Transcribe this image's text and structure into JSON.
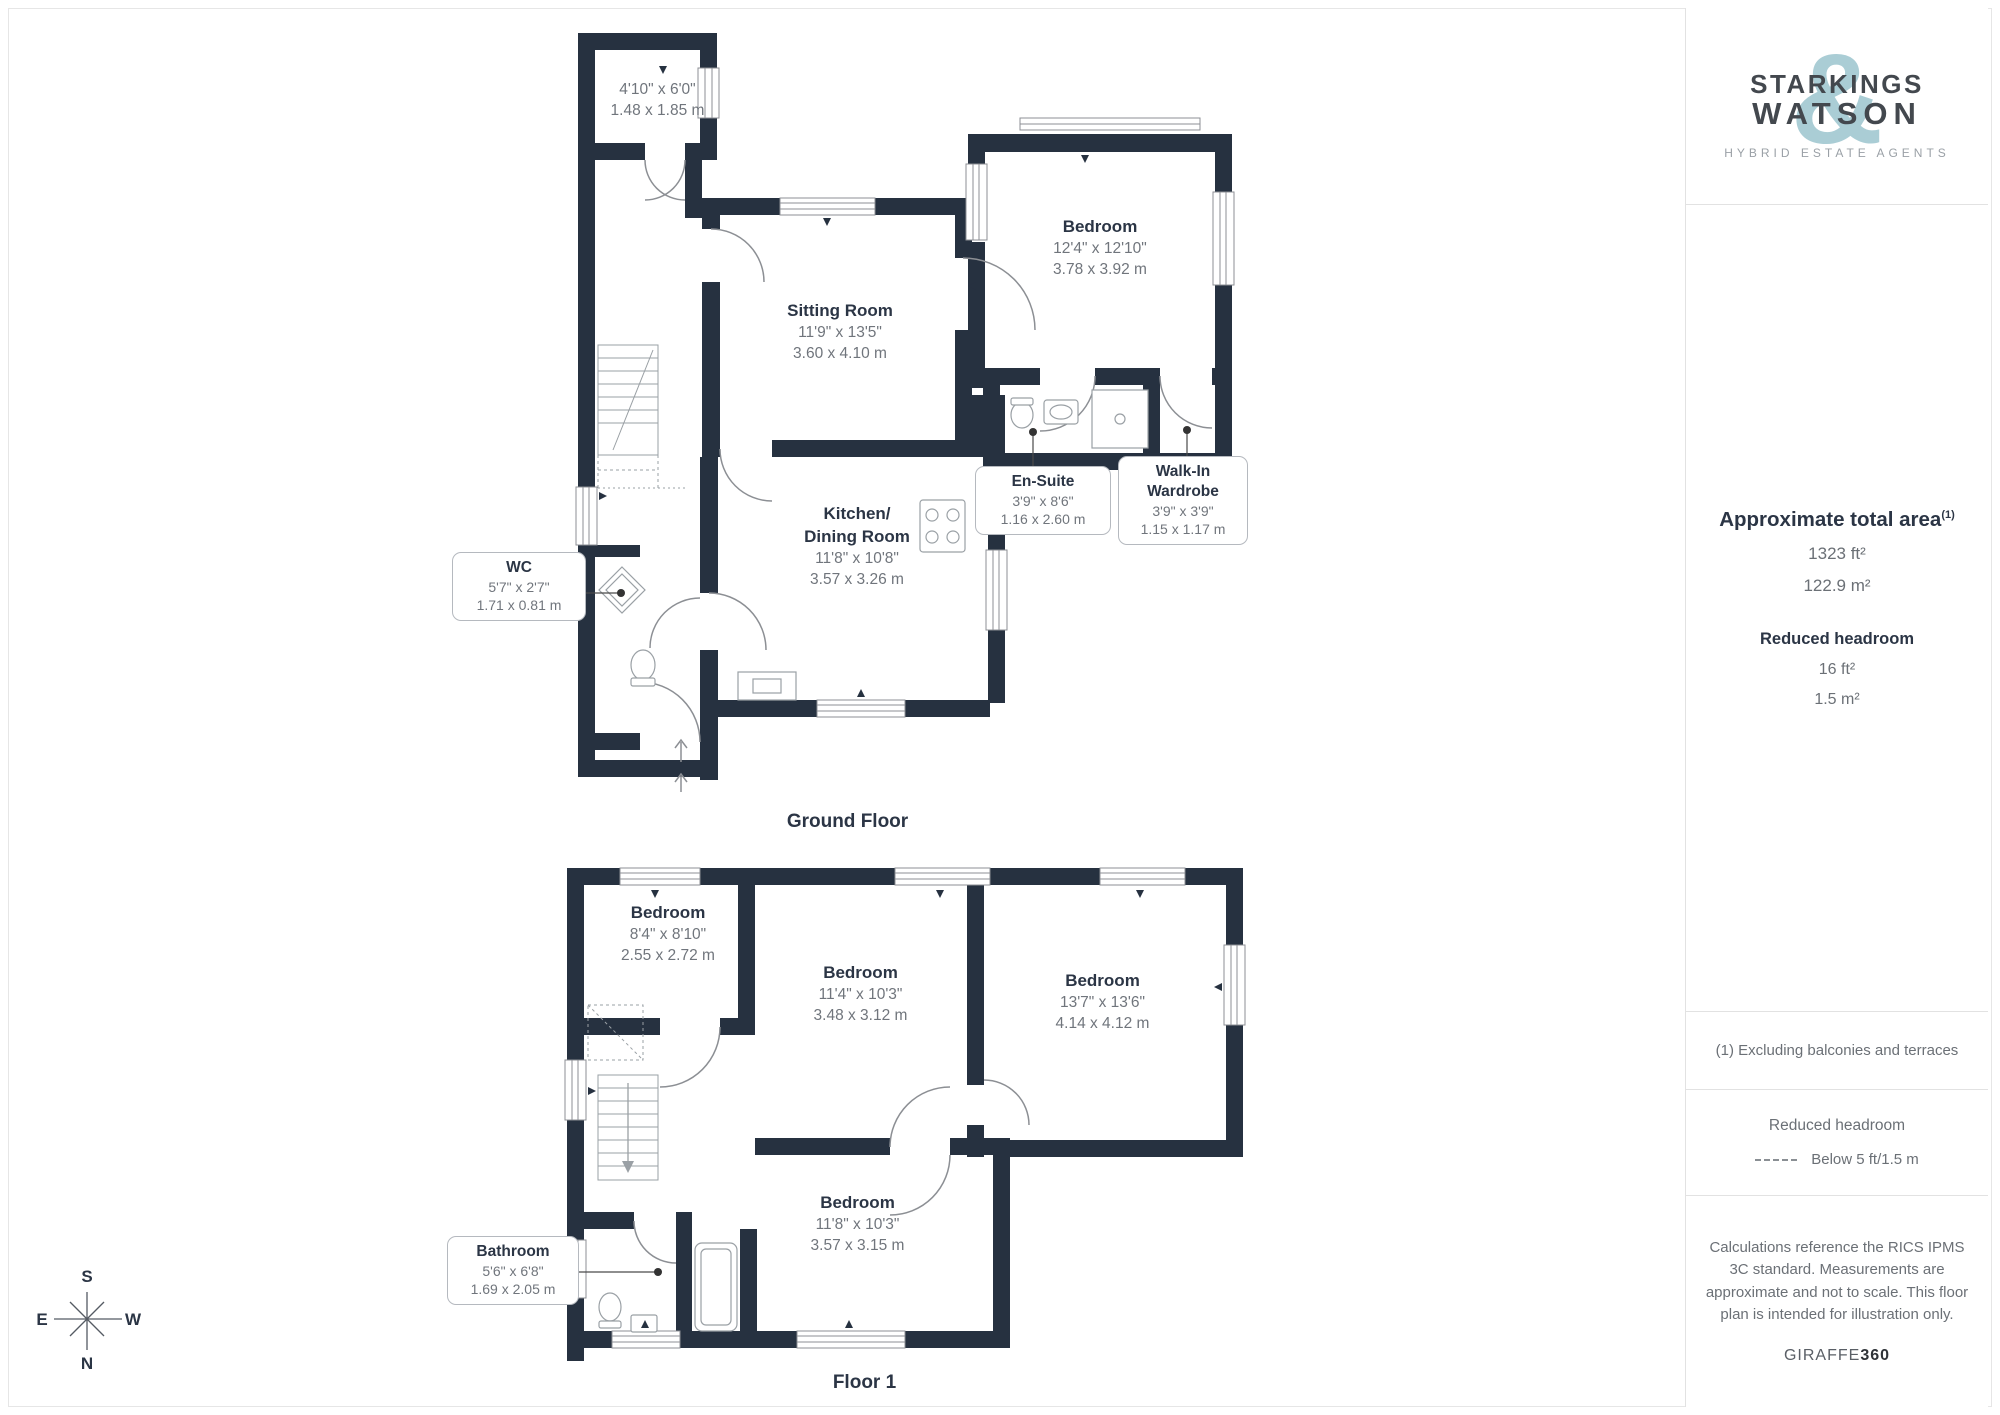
{
  "branding": {
    "logo_line1": "STARKINGS",
    "logo_line2": "WATSON",
    "logo_ampersand": "&",
    "tagline": "HYBRID ESTATE AGENTS"
  },
  "sidebar": {
    "area_title": "Approximate total area",
    "area_sup": "(1)",
    "area_ft": "1323 ft²",
    "area_m": "122.9 m²",
    "reduced_title": "Reduced headroom",
    "reduced_ft": "16 ft²",
    "reduced_m": "1.5 m²",
    "note1": "(1) Excluding balconies and terraces",
    "legend_title": "Reduced headroom",
    "legend_value": "Below 5 ft/1.5 m",
    "disclaimer": "Calculations reference the RICS IPMS 3C standard. Measurements are approximate and not to scale. This floor plan is intended for illustration only.",
    "brand_giraffe": "GIRAFFE",
    "brand_360": "360"
  },
  "ground_floor": {
    "title": "Ground Floor",
    "store": {
      "ft": "4'10\" x 6'0\"",
      "m": "1.48 x 1.85 m"
    },
    "sitting": {
      "name": "Sitting Room",
      "ft": "11'9\" x 13'5\"",
      "m": "3.60 x 4.10 m"
    },
    "bedroom": {
      "name": "Bedroom",
      "ft": "12'4\" x 12'10\"",
      "m": "3.78 x 3.92 m"
    },
    "ensuite": {
      "name": "En-Suite",
      "ft": "3'9\" x 8'6\"",
      "m": "1.16 x 2.60 m"
    },
    "wardrobe": {
      "name": "Walk-In\nWardrobe",
      "ft": "3'9\" x 3'9\"",
      "m": "1.15 x 1.17 m"
    },
    "kitchen": {
      "name": "Kitchen/\nDining Room",
      "ft": "11'8\" x 10'8\"",
      "m": "3.57 x 3.26 m"
    },
    "wc": {
      "name": "WC",
      "ft": "5'7\" x 2'7\"",
      "m": "1.71 x 0.81 m"
    }
  },
  "floor_1": {
    "title": "Floor 1",
    "bed_small": {
      "name": "Bedroom",
      "ft": "8'4\" x 8'10\"",
      "m": "2.55 x 2.72 m"
    },
    "bed_mid": {
      "name": "Bedroom",
      "ft": "11'4\" x 10'3\"",
      "m": "3.48 x 3.12 m"
    },
    "bed_right": {
      "name": "Bedroom",
      "ft": "13'7\" x 13'6\"",
      "m": "4.14 x 4.12 m"
    },
    "bed_bottom": {
      "name": "Bedroom",
      "ft": "11'8\" x 10'3\"",
      "m": "3.57 x 3.15 m"
    },
    "bathroom": {
      "name": "Bathroom",
      "ft": "5'6\" x 6'8\"",
      "m": "1.69 x 2.05 m"
    }
  },
  "compass": {
    "top": "S",
    "left": "E",
    "right": "W",
    "bottom": "N"
  },
  "colors": {
    "wall": "#263140",
    "accent_teal": "#aacdd5"
  }
}
